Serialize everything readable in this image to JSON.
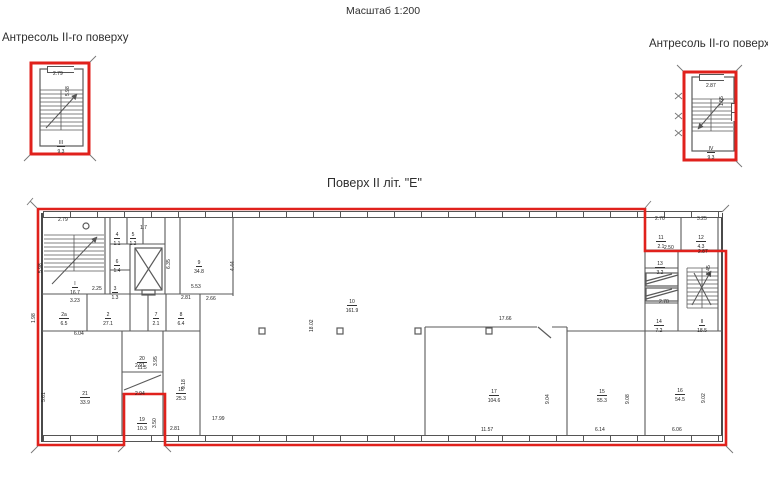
{
  "page": {
    "scale_label": "Масштаб 1:200"
  },
  "mezzanine_left": {
    "title": "Антресоль II-го поверху",
    "dim_width": "2.79",
    "dim_height": "5.98",
    "room": {
      "num": "III",
      "area": "9.3"
    }
  },
  "mezzanine_right": {
    "title": "Антресоль II-го поверху",
    "dim_width": "2.87",
    "dim_height": "1.55",
    "room": {
      "num": "IV",
      "area": "9.3"
    }
  },
  "floor": {
    "title": "Поверх II літ. \"Е\"",
    "rooms": [
      {
        "num": "I",
        "area": "16.7"
      },
      {
        "num": "2а",
        "area": "6.5"
      },
      {
        "num": "2",
        "area": "27.1"
      },
      {
        "num": "3",
        "area": "1.3"
      },
      {
        "num": "4",
        "area": "1.1"
      },
      {
        "num": "5",
        "area": "1.2"
      },
      {
        "num": "6",
        "area": "1.4"
      },
      {
        "num": "7",
        "area": "2.1"
      },
      {
        "num": "8",
        "area": "6.4"
      },
      {
        "num": "9",
        "area": "34.8"
      },
      {
        "num": "10",
        "area": "161.9"
      },
      {
        "num": "11",
        "area": "2.1"
      },
      {
        "num": "12",
        "area": "4.3"
      },
      {
        "num": "13",
        "area": "3.2"
      },
      {
        "num": "II",
        "area": "18.5"
      },
      {
        "num": "14",
        "area": "7.2"
      },
      {
        "num": "15",
        "area": "55.3"
      },
      {
        "num": "16",
        "area": "54.5"
      },
      {
        "num": "17",
        "area": "104.6"
      },
      {
        "num": "18",
        "area": "25.3"
      },
      {
        "num": "19",
        "area": "10.3"
      },
      {
        "num": "20",
        "area": "11.5"
      },
      {
        "num": "21",
        "area": "33.9"
      }
    ],
    "dims": [
      "2.79",
      "5.98",
      "2.25",
      "3.23",
      "1.98",
      "2.81",
      "2.66",
      "5.53",
      "4.44",
      "6.35",
      "18.02",
      "17.66",
      "17.99",
      "11.57",
      "9.04",
      "6.14",
      "9.08",
      "6.06",
      "9.02",
      "9.18",
      "2.81",
      "2.94",
      "3.50",
      "2.91",
      "3.95",
      "6.04",
      "5.61",
      "2.70",
      "3.25",
      "2.50",
      "2.87",
      "3.45",
      "2.70",
      "1.7"
    ]
  }
}
